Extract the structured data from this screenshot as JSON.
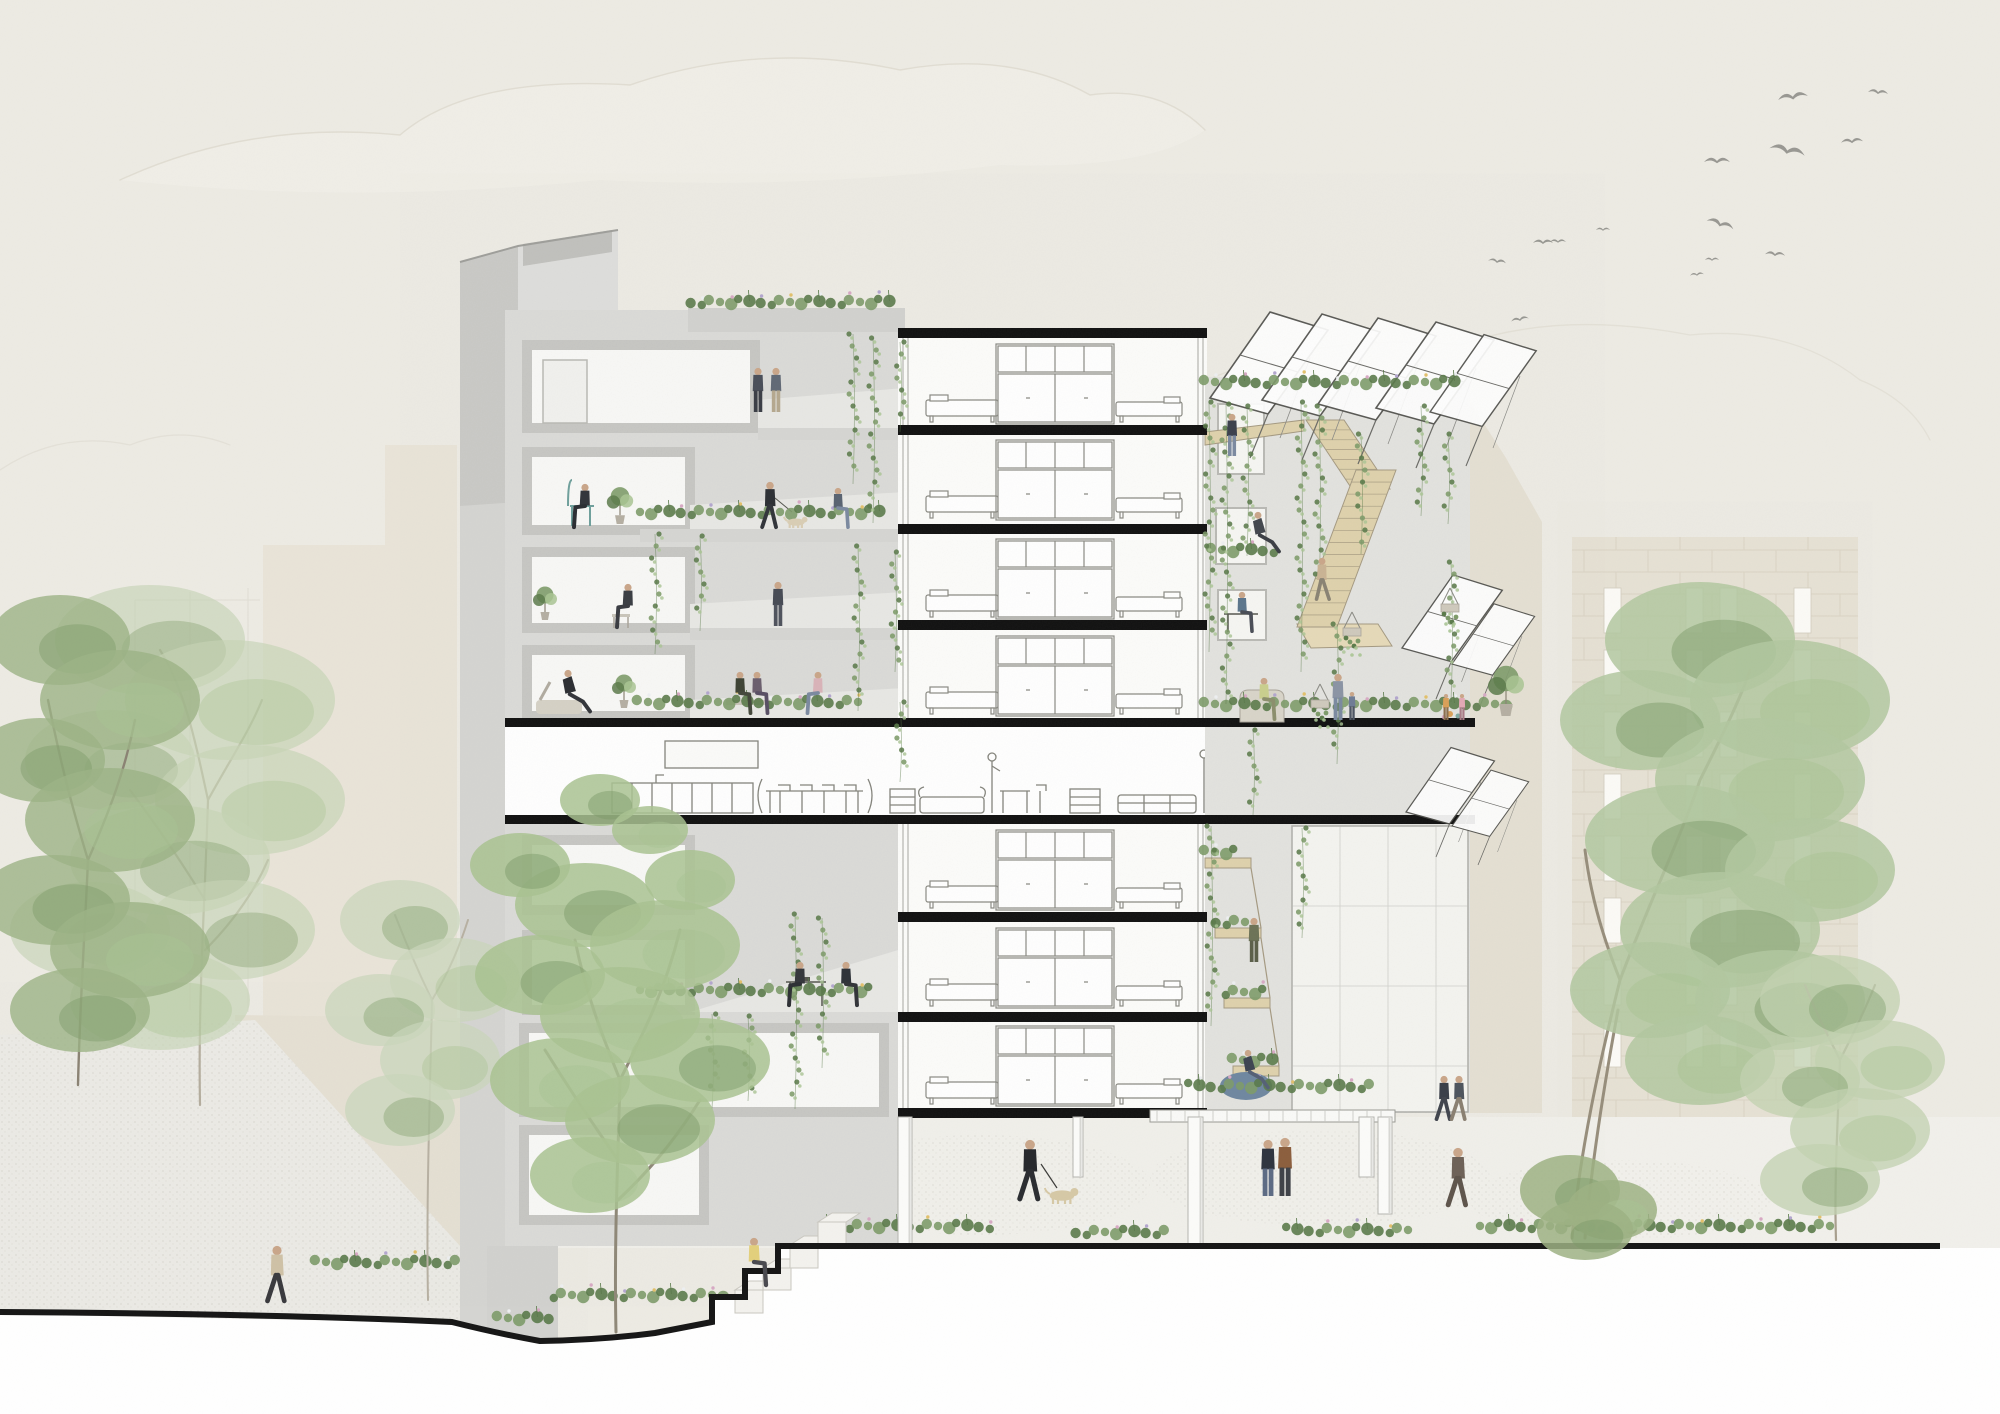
{
  "scene": {
    "kind": "architectural-section-collage",
    "subject": "multi-storey co-housing building cut section with terraces, communal floor, stairs, trees, people and birds"
  },
  "palette": {
    "sky": "#edebe4",
    "cloud_line": "#dbd7cb",
    "cloud_fill": "#f3f1ea",
    "concrete_bg": "#dbdbd8",
    "concrete_light": "#e3e3df",
    "concrete_mid": "#d2d2cf",
    "concrete_frame": "#c3c3c0",
    "concrete_wall": "#d5d5d2",
    "room_white": "#f8f8f6",
    "pure_white": "#ffffff",
    "slab": "#111111",
    "ground_line": "#161616",
    "line_art": "#84847c",
    "wood": "#dfd2ac",
    "wood_dark": "#a59a82",
    "green_dark": "#5a7a4a",
    "green_mid": "#7d9b69",
    "green_light": "#a9c493",
    "green_pale": "#c9d8ba",
    "flower_white": "#eef0f2",
    "flower_pink": "#d8a9c4",
    "flower_lavender": "#b3a6cf",
    "flower_yellow": "#e3c06b",
    "beige_bg": "#e9e4d8",
    "beige_bg2": "#e7e2d5",
    "block_line": "#d8d1c0",
    "window_white": "#fbfaf6",
    "right_wall": "#e5e0d3",
    "skin": "#c9a68a",
    "bird": "#8f8f8a",
    "ground": "#f1f0eb",
    "deck": "#fafaf8",
    "beanbag": "#6f87a0",
    "dog": "#d6c8a6"
  },
  "birds": [
    {
      "x": 1793,
      "y": 98,
      "s": 15,
      "rot": -8
    },
    {
      "x": 1878,
      "y": 93,
      "s": 10,
      "rot": 6
    },
    {
      "x": 1787,
      "y": 152,
      "s": 18,
      "rot": 12
    },
    {
      "x": 1852,
      "y": 142,
      "s": 11,
      "rot": -4
    },
    {
      "x": 1717,
      "y": 162,
      "s": 13,
      "rot": 0
    },
    {
      "x": 1720,
      "y": 225,
      "s": 14,
      "rot": 18
    },
    {
      "x": 1775,
      "y": 255,
      "s": 10,
      "rot": 4
    },
    {
      "x": 1712,
      "y": 260,
      "s": 7,
      "rot": 0
    },
    {
      "x": 1697,
      "y": 275,
      "s": 7,
      "rot": -6
    },
    {
      "x": 1543,
      "y": 243,
      "s": 10,
      "rot": 0
    },
    {
      "x": 1497,
      "y": 262,
      "s": 9,
      "rot": 8
    },
    {
      "x": 1603,
      "y": 230,
      "s": 7,
      "rot": 0
    },
    {
      "x": 1520,
      "y": 320,
      "s": 9,
      "rot": -10
    },
    {
      "x": 1558,
      "y": 242,
      "s": 8,
      "rot": 0
    }
  ],
  "background": {
    "left_masses": [
      {
        "x": 263,
        "y": 545,
        "w": 122,
        "h": 705
      },
      {
        "x": 385,
        "y": 445,
        "w": 72,
        "h": 805
      }
    ],
    "right_building": {
      "x": 1572,
      "y": 545,
      "w": 286,
      "h": 702,
      "window_cols": [
        1604,
        1686,
        1720,
        1794
      ],
      "window_w": 17,
      "window_h": 45,
      "window_row_start": 588,
      "window_row_pitch": 62,
      "window_rows": 8
    }
  },
  "building": {
    "slabs_wide": [
      {
        "x": 505,
        "y": 718,
        "w": 970,
        "h": 9
      },
      {
        "x": 505,
        "y": 815,
        "w": 970,
        "h": 9
      }
    ],
    "slabs_mid": {
      "x": 898,
      "w": 309,
      "h": 10,
      "ys": [
        328,
        425,
        524,
        620,
        912,
        1012,
        1108
      ]
    },
    "furniture_floor_ys": [
      338,
      434,
      533,
      630,
      824,
      922,
      1020
    ],
    "pilotis": [
      {
        "x": 898,
        "y": 1117,
        "w": 14,
        "h": 128
      },
      {
        "x": 1073,
        "y": 1117,
        "w": 10,
        "h": 60
      },
      {
        "x": 1188,
        "y": 1117,
        "w": 15,
        "h": 127
      },
      {
        "x": 1359,
        "y": 1117,
        "w": 15,
        "h": 60
      },
      {
        "x": 1378,
        "y": 1117,
        "w": 14,
        "h": 97
      }
    ]
  },
  "vines": [
    {
      "x": 853,
      "y": 334,
      "len": 150
    },
    {
      "x": 873,
      "y": 338,
      "len": 185
    },
    {
      "x": 900,
      "y": 342,
      "len": 90
    },
    {
      "x": 655,
      "y": 534,
      "len": 120
    },
    {
      "x": 700,
      "y": 536,
      "len": 95
    },
    {
      "x": 858,
      "y": 546,
      "len": 165
    },
    {
      "x": 895,
      "y": 552,
      "len": 120
    },
    {
      "x": 900,
      "y": 702,
      "len": 80
    },
    {
      "x": 795,
      "y": 914,
      "len": 195
    },
    {
      "x": 822,
      "y": 918,
      "len": 150
    },
    {
      "x": 712,
      "y": 1014,
      "len": 95
    },
    {
      "x": 748,
      "y": 1016,
      "len": 85
    },
    {
      "x": 1209,
      "y": 402,
      "len": 250
    },
    {
      "x": 1226,
      "y": 404,
      "len": 300
    },
    {
      "x": 1247,
      "y": 406,
      "len": 150
    },
    {
      "x": 1301,
      "y": 402,
      "len": 270
    },
    {
      "x": 1319,
      "y": 406,
      "len": 190
    },
    {
      "x": 1361,
      "y": 434,
      "len": 120
    },
    {
      "x": 1421,
      "y": 406,
      "len": 110
    },
    {
      "x": 1448,
      "y": 434,
      "len": 90
    },
    {
      "x": 1337,
      "y": 624,
      "len": 140
    },
    {
      "x": 1451,
      "y": 562,
      "len": 140
    },
    {
      "x": 1253,
      "y": 730,
      "len": 85
    },
    {
      "x": 1211,
      "y": 826,
      "len": 200
    },
    {
      "x": 1302,
      "y": 828,
      "len": 110
    }
  ],
  "flower_beds": [
    {
      "x": 690,
      "y": 302,
      "w": 212
    },
    {
      "x": 640,
      "y": 512,
      "w": 255
    },
    {
      "x": 638,
      "y": 702,
      "w": 235
    },
    {
      "x": 640,
      "y": 990,
      "w": 240
    },
    {
      "x": 1205,
      "y": 382,
      "w": 262
    },
    {
      "x": 1212,
      "y": 550,
      "w": 76
    },
    {
      "x": 1205,
      "y": 704,
      "w": 313
    },
    {
      "x": 1205,
      "y": 852,
      "w": 48
    },
    {
      "x": 1215,
      "y": 922,
      "w": 48
    },
    {
      "x": 1224,
      "y": 992,
      "w": 50
    },
    {
      "x": 1233,
      "y": 1060,
      "w": 56
    },
    {
      "x": 1190,
      "y": 1086,
      "w": 195
    },
    {
      "x": 828,
      "y": 1226,
      "w": 175
    },
    {
      "x": 1075,
      "y": 1232,
      "w": 105
    },
    {
      "x": 1288,
      "y": 1230,
      "w": 135
    },
    {
      "x": 1480,
      "y": 1226,
      "w": 365
    },
    {
      "x": 316,
      "y": 1262,
      "w": 158
    },
    {
      "x": 498,
      "y": 1318,
      "w": 60
    },
    {
      "x": 552,
      "y": 1295,
      "w": 185
    }
  ],
  "potted_plants": [
    {
      "x": 620,
      "y": 524,
      "s": 11
    },
    {
      "x": 545,
      "y": 620,
      "s": 10
    },
    {
      "x": 624,
      "y": 708,
      "s": 10
    },
    {
      "x": 1506,
      "y": 716,
      "s": 15
    }
  ],
  "hanging_baskets": [
    {
      "x": 1352,
      "y": 628
    },
    {
      "x": 1450,
      "y": 604
    },
    {
      "x": 1320,
      "y": 700
    }
  ],
  "people": [
    {
      "pose": "stand",
      "x": 758,
      "y": 412,
      "h": 44,
      "shirt": "#4a4f5a",
      "pants": "#3b3e46"
    },
    {
      "pose": "stand",
      "x": 776,
      "y": 412,
      "h": 44,
      "shirt": "#626a76",
      "pants": "#b5a88f"
    },
    {
      "pose": "sit",
      "x": 585,
      "y": 528,
      "h": 44,
      "shirt": "#33353b",
      "pants": "#2c2e33",
      "flip": true
    },
    {
      "pose": "walk",
      "x": 770,
      "y": 528,
      "h": 46,
      "shirt": "#2e3136",
      "pants": "#33363c"
    },
    {
      "pose": "dog",
      "x": 796,
      "y": 528,
      "h": 14,
      "shirt": "#d9cdb4"
    },
    {
      "pose": "sit",
      "x": 838,
      "y": 528,
      "h": 40,
      "shirt": "#5a6472",
      "pants": "#7c8aa0"
    },
    {
      "pose": "sit",
      "x": 628,
      "y": 628,
      "h": 44,
      "shirt": "#3b3e44",
      "pants": "#3a3c42",
      "flip": true
    },
    {
      "pose": "stand",
      "x": 778,
      "y": 626,
      "h": 44,
      "shirt": "#474b55",
      "pants": "#50545e"
    },
    {
      "pose": "recline",
      "x": 568,
      "y": 714,
      "h": 44,
      "shirt": "#2d2f33",
      "pants": "#34363b"
    },
    {
      "pose": "sit",
      "x": 740,
      "y": 714,
      "h": 42,
      "shirt": "#3f4436",
      "pants": "#44483c"
    },
    {
      "pose": "sit",
      "x": 757,
      "y": 714,
      "h": 42,
      "shirt": "#6b5f6e",
      "pants": "#595065"
    },
    {
      "pose": "sit",
      "x": 818,
      "y": 714,
      "h": 42,
      "shirt": "#d9b3b8",
      "pants": "#7c8aa0",
      "flip": true
    },
    {
      "pose": "sit",
      "x": 800,
      "y": 1006,
      "h": 44,
      "shirt": "#35373c",
      "pants": "#2e3035",
      "flip": true
    },
    {
      "pose": "sit",
      "x": 846,
      "y": 1006,
      "h": 44,
      "shirt": "#2f3339",
      "pants": "#33353a"
    },
    {
      "pose": "stand",
      "x": 1232,
      "y": 456,
      "h": 42,
      "shirt": "#3d424d",
      "pants": "#7c8aa0"
    },
    {
      "pose": "recline",
      "x": 1258,
      "y": 554,
      "h": 42,
      "shirt": "#44484f",
      "pants": "#3c3f45"
    },
    {
      "pose": "walk",
      "x": 1322,
      "y": 600,
      "h": 42,
      "shirt": "#c9b394",
      "pants": "#8a8374",
      "flip": true
    },
    {
      "pose": "sit",
      "x": 1242,
      "y": 632,
      "h": 40,
      "shirt": "#5d768c",
      "pants": "#4a4e57"
    },
    {
      "pose": "sit",
      "x": 1264,
      "y": 720,
      "h": 42,
      "shirt": "#c9cf8e",
      "pants": "#8c8f6d"
    },
    {
      "pose": "stand",
      "x": 1338,
      "y": 720,
      "h": 46,
      "shirt": "#8b94a4",
      "pants": "#7c8aa0"
    },
    {
      "pose": "child",
      "x": 1352,
      "y": 720,
      "h": 28,
      "shirt": "#6f7d95",
      "pants": "#4e5663"
    },
    {
      "pose": "child",
      "x": 1446,
      "y": 720,
      "h": 26,
      "shirt": "#d9a05a",
      "pants": "#8c6f4e"
    },
    {
      "pose": "child",
      "x": 1462,
      "y": 720,
      "h": 26,
      "shirt": "#e2a9b5",
      "pants": "#a87c88"
    },
    {
      "pose": "stand",
      "x": 1254,
      "y": 962,
      "h": 44,
      "shirt": "#6d7358",
      "pants": "#5c604a"
    },
    {
      "pose": "recline",
      "x": 1248,
      "y": 1090,
      "h": 40,
      "shirt": "#3e4552",
      "pants": "#566176"
    },
    {
      "pose": "walk",
      "x": 1030,
      "y": 1200,
      "h": 60,
      "shirt": "#27292d",
      "pants": "#2b2d31"
    },
    {
      "pose": "dog",
      "x": 1062,
      "y": 1204,
      "h": 20,
      "shirt": "#d6c8a6"
    },
    {
      "pose": "stand",
      "x": 1268,
      "y": 1196,
      "h": 56,
      "shirt": "#2f3540",
      "pants": "#5d6b84"
    },
    {
      "pose": "stand",
      "x": 1285,
      "y": 1196,
      "h": 58,
      "shirt": "#8c5f3e",
      "pants": "#3f4248"
    },
    {
      "pose": "walk",
      "x": 1458,
      "y": 1206,
      "h": 58,
      "shirt": "#6e6258",
      "pants": "#5f554c"
    },
    {
      "pose": "walk",
      "x": 1444,
      "y": 1120,
      "h": 44,
      "shirt": "#3a3f49",
      "pants": "#41454e"
    },
    {
      "pose": "walk",
      "x": 1459,
      "y": 1120,
      "h": 44,
      "shirt": "#4e555f",
      "pants": "#8a8072"
    },
    {
      "pose": "sit",
      "x": 754,
      "y": 1286,
      "h": 48,
      "shirt": "#e3d07c",
      "pants": "#4a4a50"
    },
    {
      "pose": "walk",
      "x": 277,
      "y": 1302,
      "h": 56,
      "shirt": "#cfc1a6",
      "pants": "#3a3a3e"
    }
  ],
  "trees": [
    {
      "name": "left-back-tree",
      "tone": "#c6d4b6",
      "opacity": 0.65,
      "trunk": "M200,1105 C198,1000 205,900 208,800 M208,800 C195,740 185,690 160,650 M208,800 C230,760 250,730 262,700 M205,900 C180,860 160,830 130,790 M205,950 C235,920 255,890 268,860",
      "trunk_color": "#b4ad9e",
      "trunk_w": 2.2,
      "clusters": [
        [
          150,
          640,
          95,
          55
        ],
        [
          230,
          700,
          105,
          60
        ],
        [
          110,
          760,
          85,
          50
        ],
        [
          250,
          800,
          95,
          55
        ],
        [
          170,
          860,
          100,
          55
        ],
        [
          90,
          930,
          80,
          48
        ],
        [
          230,
          930,
          85,
          50
        ],
        [
          160,
          1000,
          90,
          50
        ]
      ]
    },
    {
      "name": "left-front-tree",
      "tone": "#9cb386",
      "opacity": 0.8,
      "trunk": "M78,1085 C80,1000 85,930 88,860 M88,860 C70,800 60,760 48,700 M88,860 C110,810 125,770 135,720",
      "trunk_color": "#8b8374",
      "trunk_w": 2.4,
      "clusters": [
        [
          60,
          640,
          70,
          45
        ],
        [
          120,
          700,
          80,
          50
        ],
        [
          40,
          760,
          65,
          42
        ],
        [
          110,
          820,
          85,
          52
        ],
        [
          55,
          900,
          75,
          45
        ],
        [
          130,
          950,
          80,
          48
        ],
        [
          80,
          1010,
          70,
          42
        ]
      ]
    },
    {
      "name": "slender-tree",
      "tone": "#c9d6ba",
      "opacity": 0.7,
      "trunk": "M428,1300 C426,1200 430,1100 432,1000 M432,1000 C415,965 405,940 395,915 M432,1000 C450,970 460,945 468,920",
      "trunk_color": "#b7b0a2",
      "trunk_w": 2,
      "clusters": [
        [
          400,
          920,
          60,
          40
        ],
        [
          455,
          980,
          65,
          42
        ],
        [
          380,
          1010,
          55,
          36
        ],
        [
          440,
          1060,
          60,
          40
        ],
        [
          400,
          1110,
          55,
          36
        ]
      ]
    },
    {
      "name": "middle-tree",
      "tone": "#a9c292",
      "opacity": 0.85,
      "trunk": "M616,1332 C614,1240 618,1160 620,1080 M620,1080 C600,1030 585,990 575,940 M620,1080 C645,1030 665,990 680,930 M618,1160 C590,1120 570,1090 545,1050 M618,1200 C650,1170 675,1140 700,1100",
      "trunk_color": "#8f8878",
      "trunk_w": 3,
      "clusters": [
        [
          585,
          905,
          70,
          42
        ],
        [
          665,
          945,
          75,
          45
        ],
        [
          540,
          975,
          65,
          40
        ],
        [
          620,
          1015,
          80,
          48
        ],
        [
          700,
          1060,
          70,
          42
        ],
        [
          560,
          1080,
          70,
          42
        ],
        [
          640,
          1120,
          75,
          45
        ],
        [
          590,
          1175,
          60,
          38
        ],
        [
          520,
          865,
          50,
          32
        ],
        [
          690,
          880,
          45,
          30
        ],
        [
          600,
          800,
          40,
          26
        ],
        [
          650,
          830,
          38,
          24
        ]
      ]
    },
    {
      "name": "right-big-tree",
      "tone": "#b2c7a0",
      "opacity": 0.85,
      "trunk": "M1572,1238 C1580,1150 1600,1060 1620,980 M1620,980 C1650,900 1680,840 1700,780 M1620,980 C1600,930 1590,890 1585,850 M1700,780 C1720,740 1740,700 1750,670 M1585,1238 C1592,1160 1605,1080 1618,1010",
      "trunk_color": "#978e7c",
      "trunk_w": 3,
      "clusters": [
        [
          1700,
          640,
          95,
          58
        ],
        [
          1790,
          700,
          100,
          60
        ],
        [
          1640,
          720,
          80,
          50
        ],
        [
          1760,
          780,
          105,
          62
        ],
        [
          1680,
          840,
          95,
          55
        ],
        [
          1810,
          870,
          85,
          52
        ],
        [
          1720,
          930,
          100,
          58
        ],
        [
          1650,
          990,
          80,
          48
        ],
        [
          1780,
          1000,
          85,
          50
        ],
        [
          1700,
          1060,
          75,
          45
        ]
      ]
    },
    {
      "name": "right-small-tree",
      "tone": "#c2d2b0",
      "opacity": 0.75,
      "trunk": "M1836,1240 C1834,1180 1838,1120 1840,1060 M1840,1060 C1825,1030 1815,1010 1805,985 M1840,1060 C1855,1030 1865,1010 1875,985",
      "trunk_color": "#a89f8e",
      "trunk_w": 2.2,
      "clusters": [
        [
          1830,
          1000,
          70,
          45
        ],
        [
          1880,
          1060,
          65,
          40
        ],
        [
          1800,
          1080,
          60,
          38
        ],
        [
          1860,
          1130,
          70,
          42
        ],
        [
          1820,
          1180,
          60,
          36
        ]
      ]
    },
    {
      "name": "right-bush",
      "tone": "#9db184",
      "opacity": 0.85,
      "trunk": "",
      "trunk_color": "#9db184",
      "trunk_w": 0,
      "clusters": [
        [
          1570,
          1190,
          50,
          35
        ],
        [
          1612,
          1210,
          45,
          30
        ],
        [
          1585,
          1230,
          48,
          30
        ]
      ]
    }
  ],
  "canopies": [
    {
      "x": 1210,
      "y": 398,
      "s": 1
    },
    {
      "x": 1262,
      "y": 400,
      "s": 1
    },
    {
      "x": 1318,
      "y": 404,
      "s": 1
    },
    {
      "x": 1376,
      "y": 408,
      "s": 1
    },
    {
      "x": 1430,
      "y": 412,
      "s": 0.9
    },
    {
      "x": 1402,
      "y": 648,
      "s": 0.85
    },
    {
      "x": 1452,
      "y": 664,
      "s": 0.7
    },
    {
      "x": 1406,
      "y": 812,
      "s": 0.75
    },
    {
      "x": 1452,
      "y": 826,
      "s": 0.65
    }
  ],
  "stairs": [
    {
      "x1": 1306,
      "x2": 1344,
      "y1": 420,
      "xb1": 1352,
      "xb2": 1390,
      "y2": 489,
      "n": 7
    },
    {
      "x1": 1356,
      "x2": 1396,
      "y1": 470,
      "xb1": 1297,
      "xb2": 1337,
      "y2": 627,
      "n": 13
    }
  ]
}
